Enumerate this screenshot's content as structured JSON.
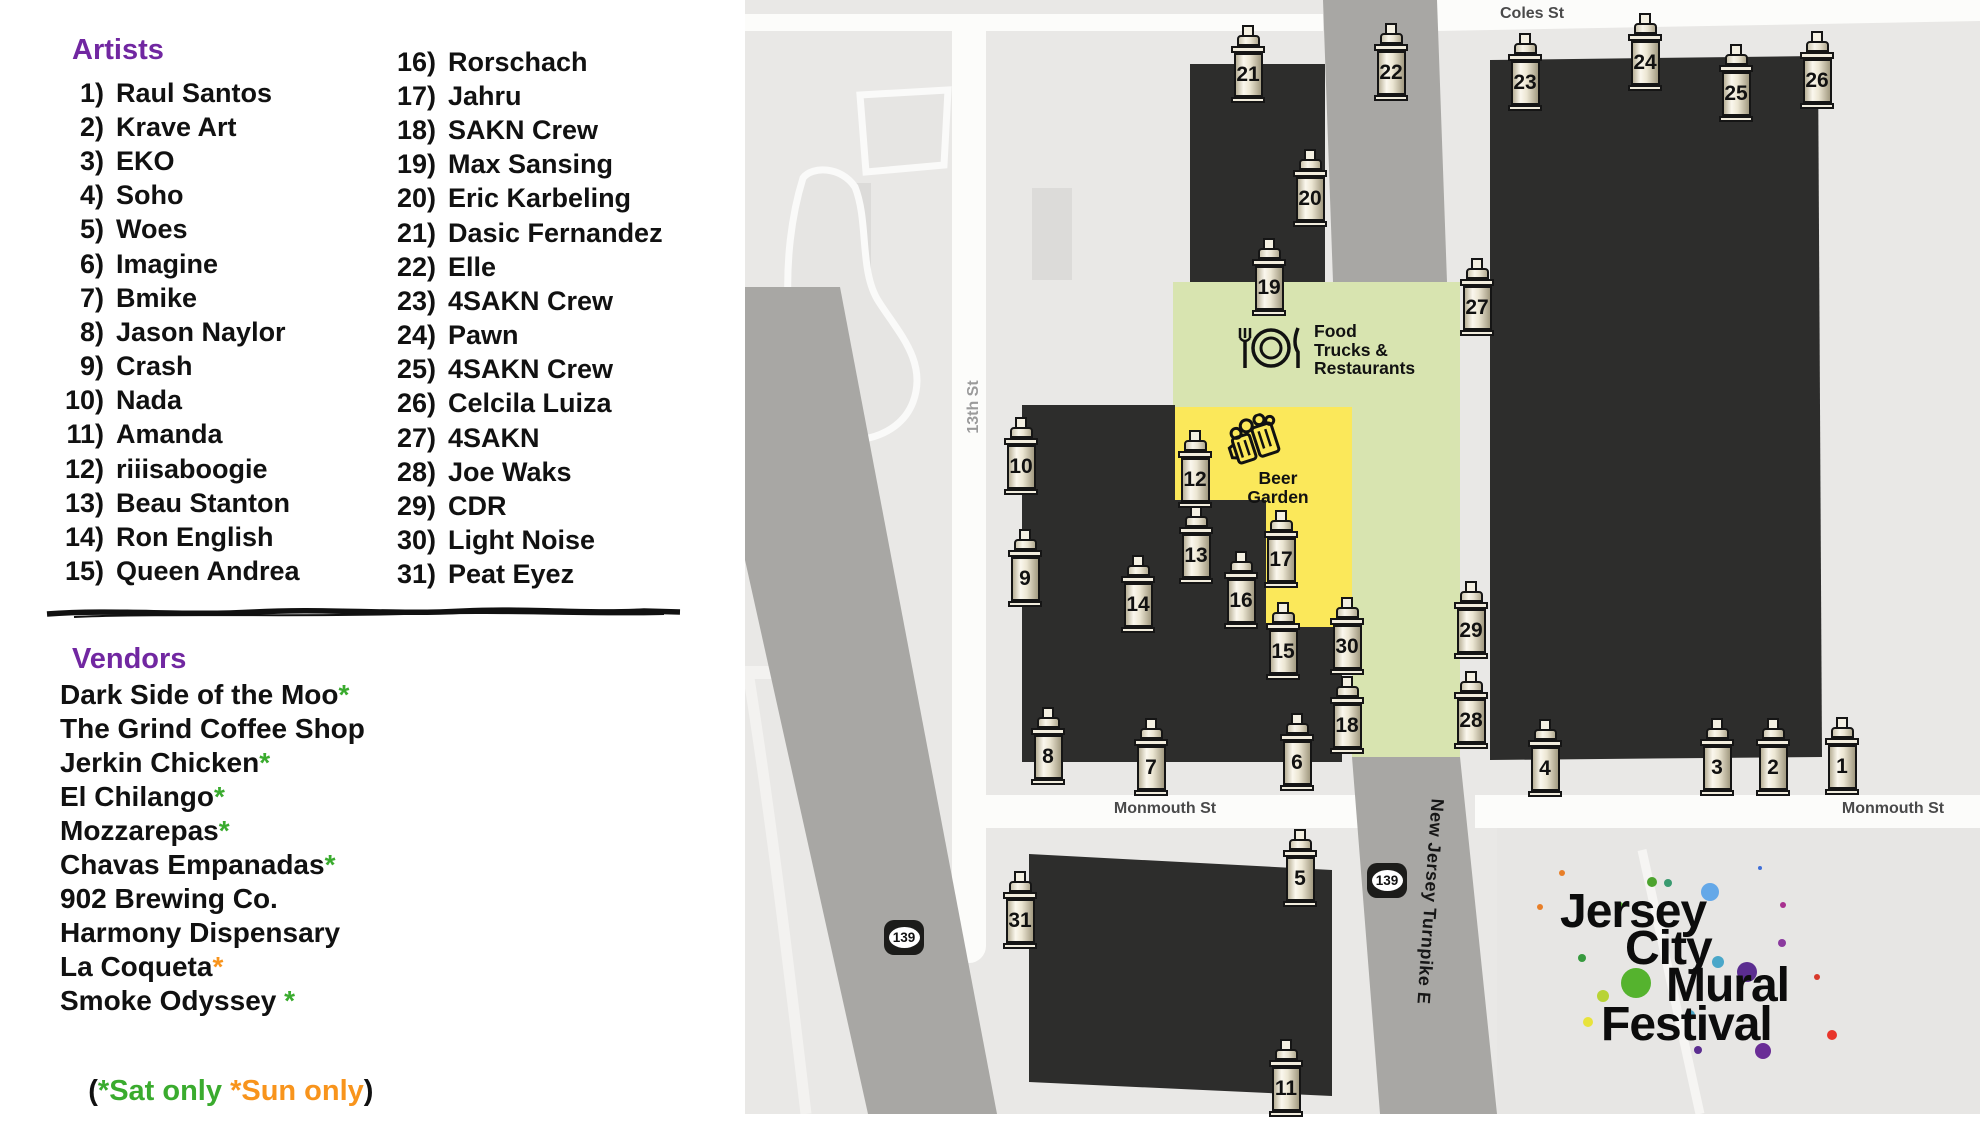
{
  "left_panel": {
    "artists_title": "Artists",
    "artists": [
      {
        "num": "1)",
        "name": "Raul Santos"
      },
      {
        "num": "2)",
        "name": "Krave Art"
      },
      {
        "num": "3)",
        "name": "EKO"
      },
      {
        "num": "4)",
        "name": "Soho"
      },
      {
        "num": "5)",
        "name": "Woes"
      },
      {
        "num": "6)",
        "name": "Imagine"
      },
      {
        "num": "7)",
        "name": "Bmike"
      },
      {
        "num": "8)",
        "name": "Jason Naylor"
      },
      {
        "num": "9)",
        "name": "Crash"
      },
      {
        "num": "10)",
        "name": "Nada"
      },
      {
        "num": "11)",
        "name": "Amanda"
      },
      {
        "num": "12)",
        "name": "riiisaboogie"
      },
      {
        "num": "13)",
        "name": "Beau Stanton"
      },
      {
        "num": "14)",
        "name": "Ron English"
      },
      {
        "num": "15)",
        "name": "Queen Andrea"
      },
      {
        "num": "16)",
        "name": "Rorschach"
      },
      {
        "num": "17)",
        "name": "Jahru"
      },
      {
        "num": "18)",
        "name": "SAKN Crew"
      },
      {
        "num": "19)",
        "name": "Max Sansing"
      },
      {
        "num": "20)",
        "name": "Eric Karbeling"
      },
      {
        "num": "21)",
        "name": "Dasic Fernandez"
      },
      {
        "num": "22)",
        "name": "Elle"
      },
      {
        "num": "23)",
        "name": "4SAKN Crew"
      },
      {
        "num": "24)",
        "name": "Pawn"
      },
      {
        "num": "25)",
        "name": "4SAKN Crew"
      },
      {
        "num": "26)",
        "name": "Celcila Luiza"
      },
      {
        "num": "27)",
        "name": "4SAKN"
      },
      {
        "num": "28)",
        "name": "Joe Waks"
      },
      {
        "num": "29)",
        "name": "CDR"
      },
      {
        "num": "30)",
        "name": "Light Noise"
      },
      {
        "num": "31)",
        "name": "Peat Eyez"
      }
    ],
    "vendors_title": "Vendors",
    "vendors": [
      {
        "name": "Dark Side of the Moo",
        "mark": "*",
        "mark_color": "green"
      },
      {
        "name": "The Grind Coffee Shop",
        "mark": "",
        "mark_color": ""
      },
      {
        "name": "Jerkin Chicken",
        "mark": "*",
        "mark_color": "green"
      },
      {
        "name": "El Chilango",
        "mark": "*",
        "mark_color": "green"
      },
      {
        "name": "Mozzarepas",
        "mark": "*",
        "mark_color": "green"
      },
      {
        "name": "Chavas Empanadas",
        "mark": "*",
        "mark_color": "green"
      },
      {
        "name": "902 Brewing Co.",
        "mark": "",
        "mark_color": ""
      },
      {
        "name": "Harmony Dispensary",
        "mark": "",
        "mark_color": ""
      },
      {
        "name": "La Coqueta",
        "mark": "*",
        "mark_color": "orange"
      },
      {
        "name": "Smoke Odyssey ",
        "mark": "*",
        "mark_color": "green"
      }
    ],
    "note": {
      "open": "(",
      "sat": "*Sat only",
      "sep": " ",
      "sun": "*Sun only",
      "close": ")"
    }
  },
  "map": {
    "street_labels": {
      "coles": "Coles St",
      "thirteenth": "13th St",
      "monmouth_left": "Monmouth St",
      "monmouth_right": "Monmouth St",
      "turnpike": "New Jersey Turnpike E"
    },
    "route_badge": "139",
    "areas": {
      "food_trucks_lines": [
        "Food",
        "Trucks &",
        "Restaurants"
      ],
      "beer_garden_lines": [
        "Beer",
        "Garden"
      ]
    },
    "cans": [
      {
        "n": "1",
        "x": 1842,
        "y": 756
      },
      {
        "n": "2",
        "x": 1773,
        "y": 757
      },
      {
        "n": "3",
        "x": 1717,
        "y": 757
      },
      {
        "n": "4",
        "x": 1545,
        "y": 758
      },
      {
        "n": "5",
        "x": 1300,
        "y": 868
      },
      {
        "n": "6",
        "x": 1297,
        "y": 752
      },
      {
        "n": "7",
        "x": 1151,
        "y": 757
      },
      {
        "n": "8",
        "x": 1048,
        "y": 746
      },
      {
        "n": "9",
        "x": 1025,
        "y": 568
      },
      {
        "n": "10",
        "x": 1021,
        "y": 456
      },
      {
        "n": "11",
        "x": 1286,
        "y": 1078
      },
      {
        "n": "12",
        "x": 1195,
        "y": 469
      },
      {
        "n": "13",
        "x": 1196,
        "y": 545
      },
      {
        "n": "14",
        "x": 1138,
        "y": 594
      },
      {
        "n": "15",
        "x": 1283,
        "y": 641
      },
      {
        "n": "16",
        "x": 1241,
        "y": 590
      },
      {
        "n": "17",
        "x": 1281,
        "y": 549
      },
      {
        "n": "18",
        "x": 1347,
        "y": 715
      },
      {
        "n": "19",
        "x": 1269,
        "y": 277
      },
      {
        "n": "20",
        "x": 1310,
        "y": 188
      },
      {
        "n": "21",
        "x": 1248,
        "y": 64
      },
      {
        "n": "22",
        "x": 1391,
        "y": 62
      },
      {
        "n": "23",
        "x": 1525,
        "y": 72
      },
      {
        "n": "24",
        "x": 1645,
        "y": 52
      },
      {
        "n": "25",
        "x": 1736,
        "y": 83
      },
      {
        "n": "26",
        "x": 1817,
        "y": 70
      },
      {
        "n": "27",
        "x": 1477,
        "y": 297
      },
      {
        "n": "28",
        "x": 1471,
        "y": 710
      },
      {
        "n": "29",
        "x": 1471,
        "y": 620
      },
      {
        "n": "30",
        "x": 1347,
        "y": 636
      },
      {
        "n": "31",
        "x": 1020,
        "y": 910
      }
    ],
    "logo_lines": [
      "Jersey",
      "City",
      "Mural",
      "Festival"
    ],
    "logo_splatter": [
      {
        "x": 1710,
        "y": 892,
        "r": 9,
        "c": "#64a8e8"
      },
      {
        "x": 1636,
        "y": 983,
        "r": 15,
        "c": "#55b32e"
      },
      {
        "x": 1652,
        "y": 882,
        "r": 5,
        "c": "#4ca32e"
      },
      {
        "x": 1668,
        "y": 883,
        "r": 4,
        "c": "#3a9a70"
      },
      {
        "x": 1603,
        "y": 996,
        "r": 6,
        "c": "#b8d335"
      },
      {
        "x": 1588,
        "y": 1022,
        "r": 5,
        "c": "#e8e33b"
      },
      {
        "x": 1747,
        "y": 972,
        "r": 10,
        "c": "#5b2d90"
      },
      {
        "x": 1763,
        "y": 1051,
        "r": 8,
        "c": "#6a2d96"
      },
      {
        "x": 1782,
        "y": 943,
        "r": 4,
        "c": "#8b3a9e"
      },
      {
        "x": 1783,
        "y": 905,
        "r": 3,
        "c": "#a8308f"
      },
      {
        "x": 1832,
        "y": 1035,
        "r": 5,
        "c": "#e8352b"
      },
      {
        "x": 1817,
        "y": 977,
        "r": 3,
        "c": "#d8392b"
      },
      {
        "x": 1562,
        "y": 873,
        "r": 3,
        "c": "#e87f28"
      },
      {
        "x": 1540,
        "y": 907,
        "r": 3,
        "c": "#e87f28"
      },
      {
        "x": 1718,
        "y": 962,
        "r": 6,
        "c": "#4aa7c9"
      },
      {
        "x": 1760,
        "y": 868,
        "r": 2,
        "c": "#3f6fd8"
      },
      {
        "x": 1620,
        "y": 905,
        "r": 3,
        "c": "#55b32e"
      },
      {
        "x": 1690,
        "y": 1015,
        "r": 5,
        "c": "#4aa7c9"
      },
      {
        "x": 1698,
        "y": 1050,
        "r": 4,
        "c": "#5b2d90"
      },
      {
        "x": 1582,
        "y": 958,
        "r": 4,
        "c": "#379a3e"
      }
    ]
  },
  "colors": {
    "purple": "#7127a1",
    "green": "#3aab2e",
    "orange": "#f8941c",
    "yellow": "#fbe85a",
    "area_green": "#d8e4b0",
    "building": "#2d2d2c",
    "road_gray": "#a8a7a4",
    "street_white": "#fcfcfa",
    "map_bg": "#e9e8e6"
  }
}
